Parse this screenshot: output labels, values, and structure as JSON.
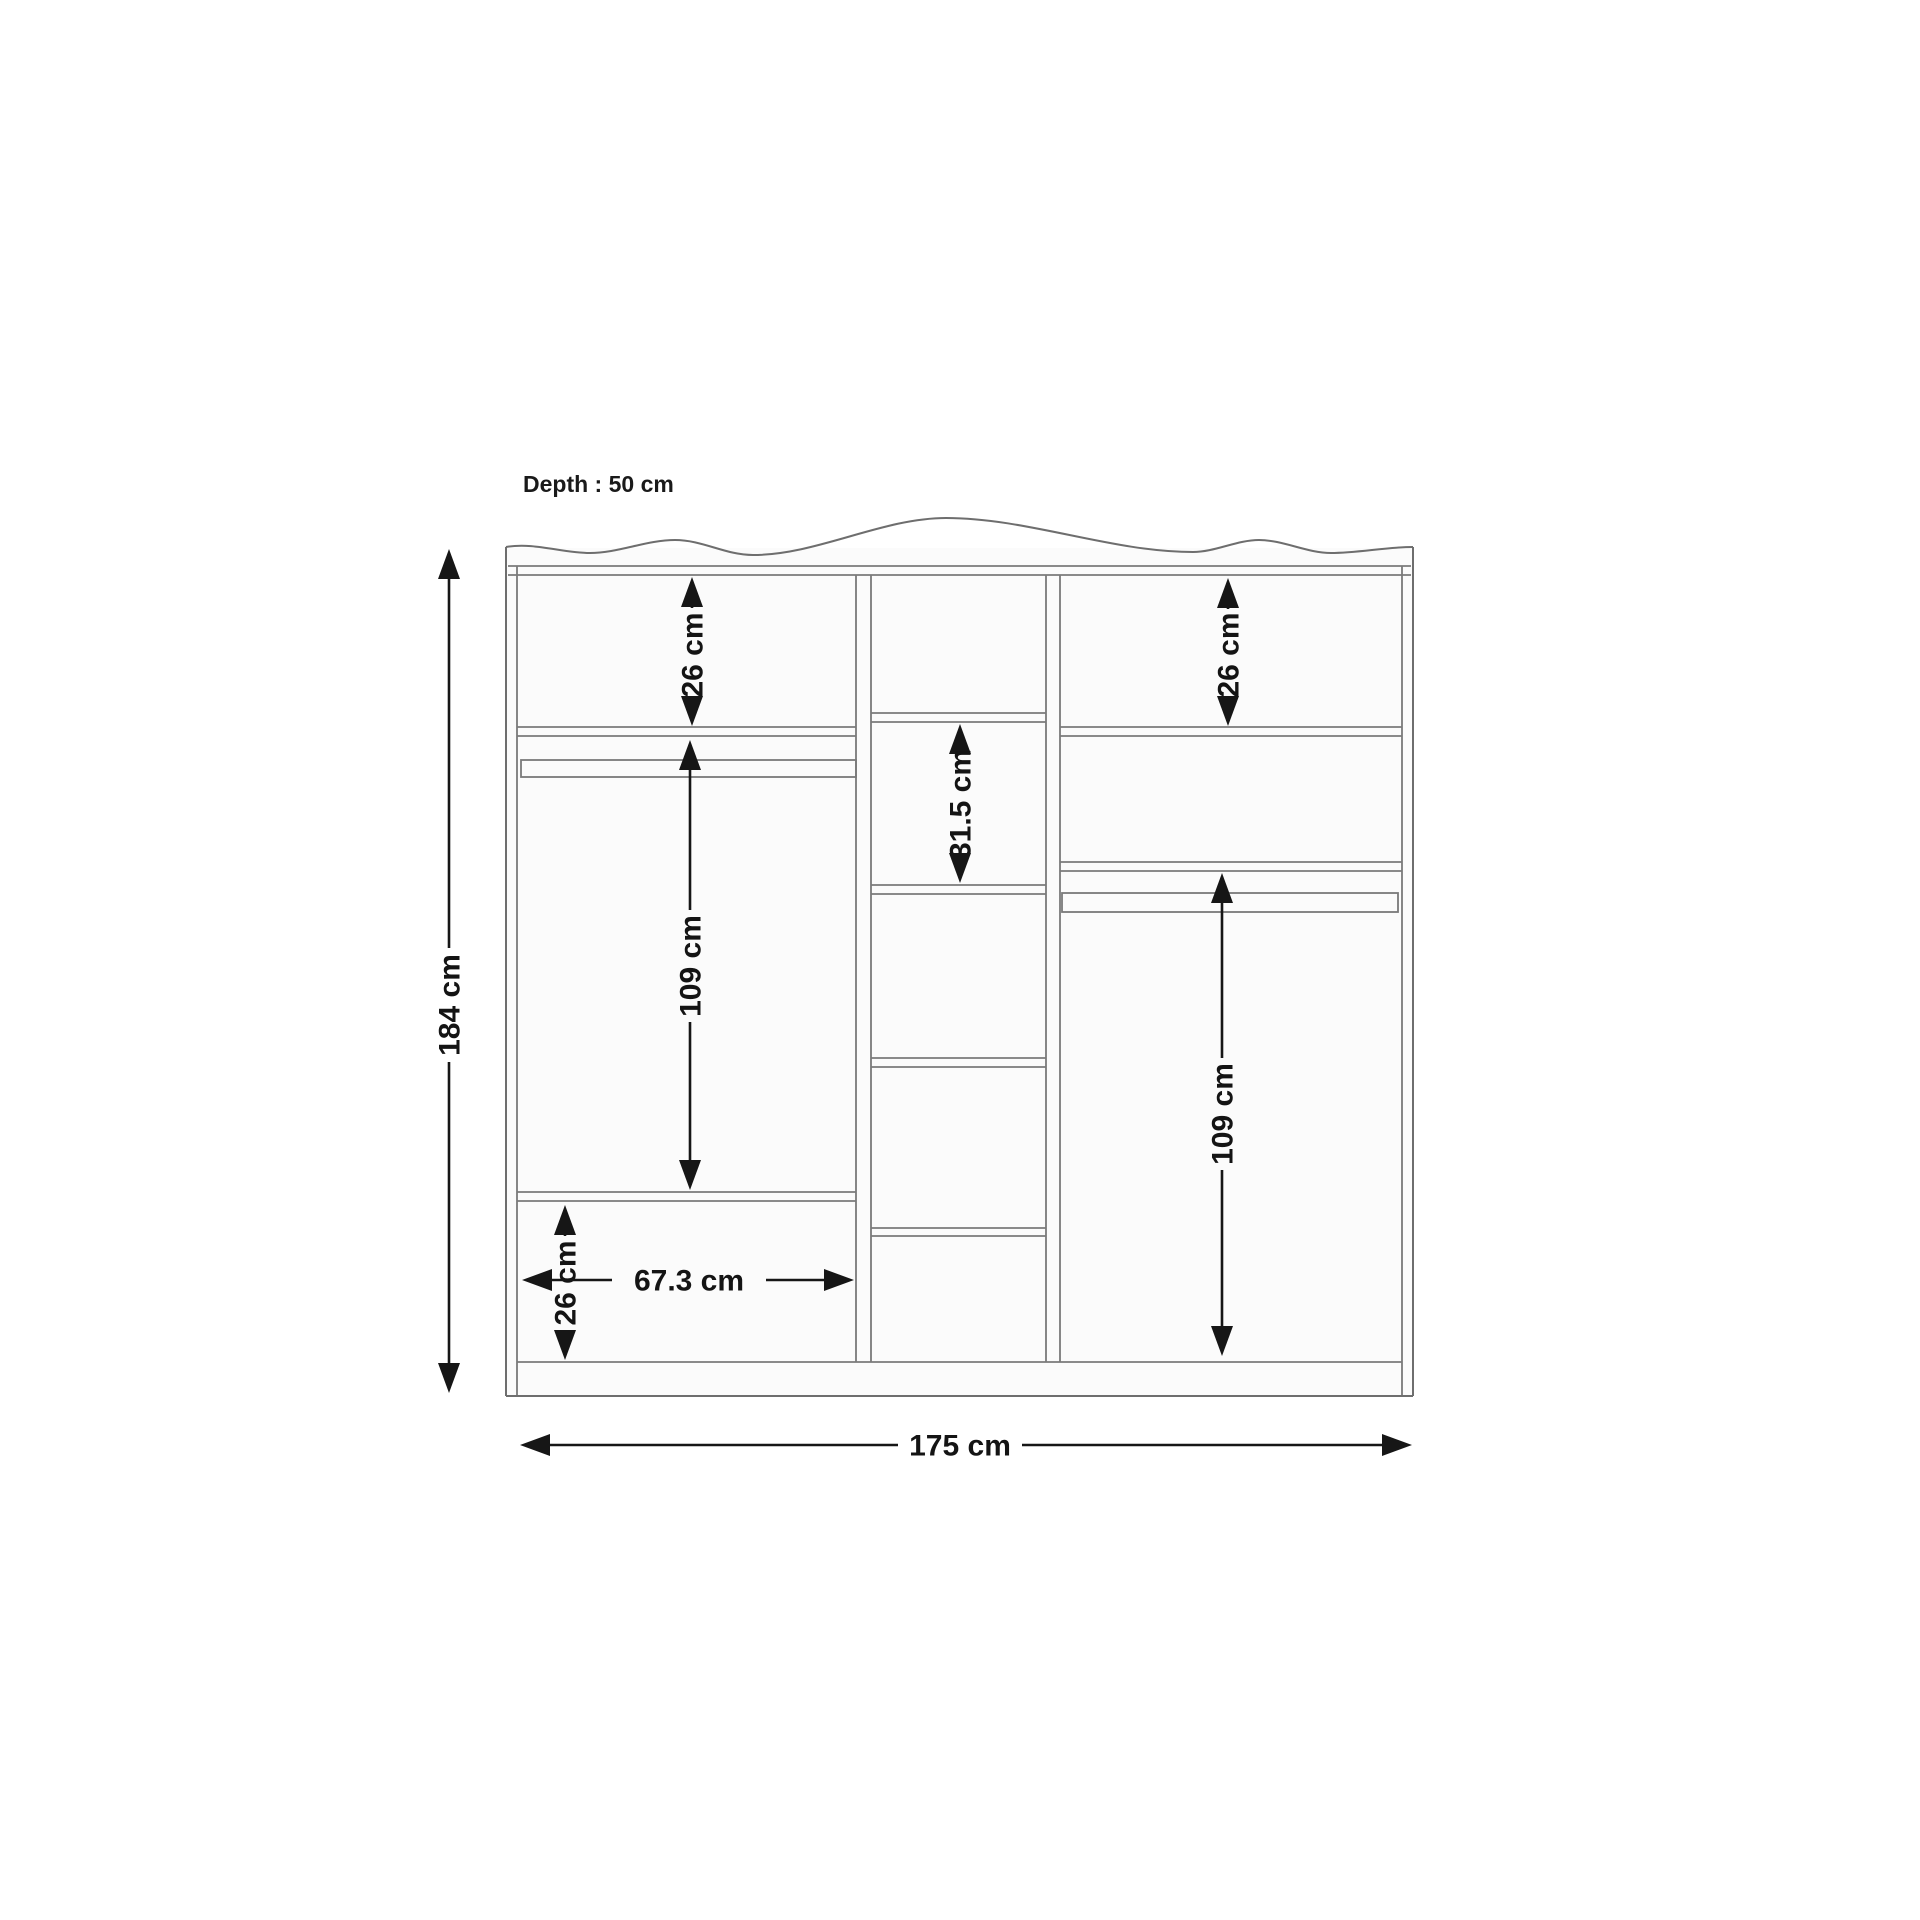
{
  "diagram": {
    "depth_label": "Depth : 50 cm",
    "dimensions": {
      "overall_height": "184 cm",
      "overall_width": "175 cm",
      "left_top_shelf_height": "26 cm",
      "right_top_shelf_height": "26 cm",
      "middle_shelf_spacing": "31.5 cm",
      "left_hanging_height": "109 cm",
      "right_hanging_height": "109 cm",
      "left_bottom_compartment_height": "26 cm",
      "left_compartment_width": "67.3 cm"
    },
    "colors": {
      "furniture_line": "#6e6e6e",
      "dimension_line": "#161616",
      "background": "#ffffff"
    }
  }
}
